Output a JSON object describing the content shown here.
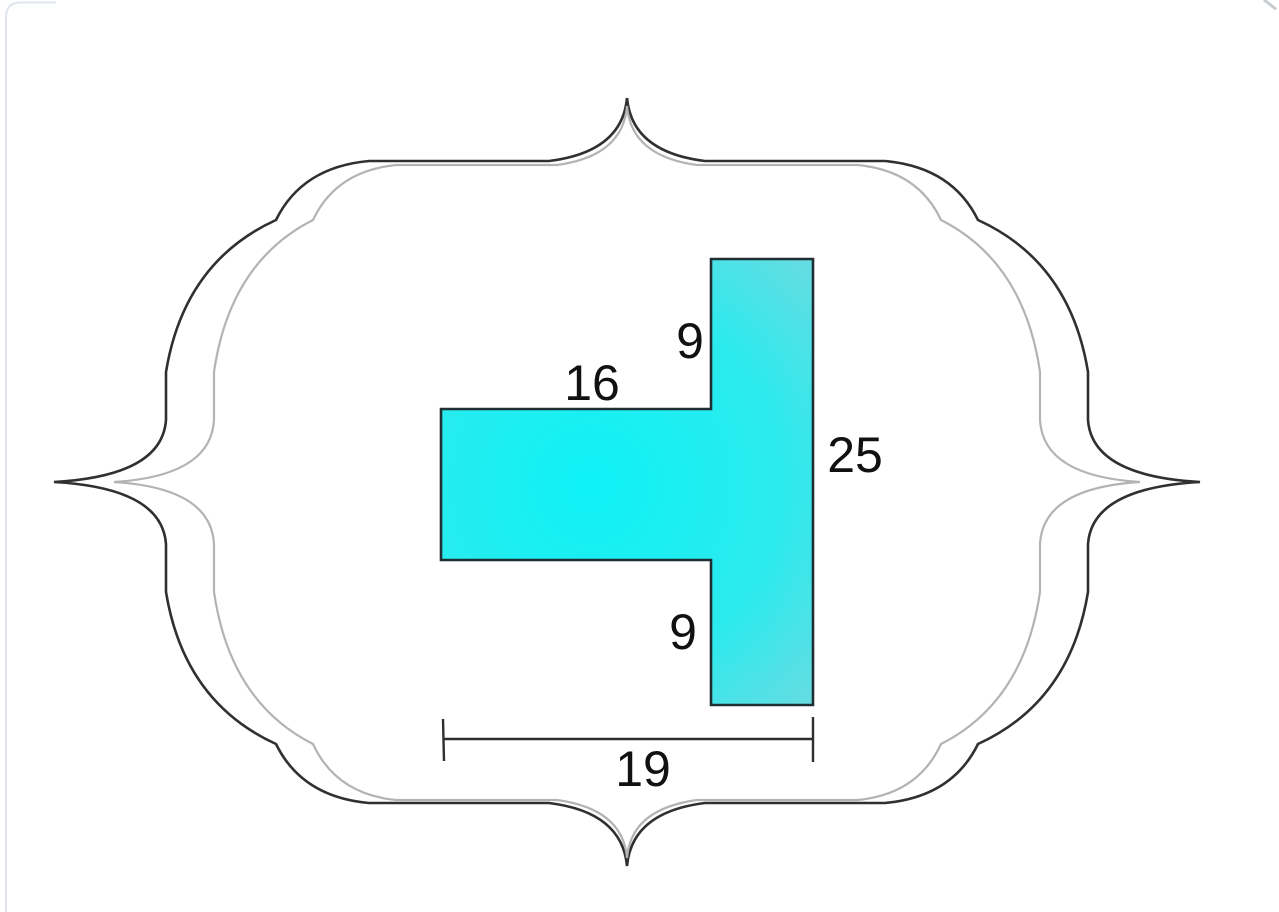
{
  "figure": {
    "description": "Composite T-shaped polygon (rotated T) with dimension labels inside an ornamental double bracket frame",
    "labels": {
      "seg_top": "9",
      "arm_top": "16",
      "right_side": "25",
      "seg_bottom": "9",
      "bottom_width": "19"
    },
    "dimensions": {
      "upper_right_vertical_segment": 9,
      "top_horizontal_arm": 16,
      "right_side_total_height": 25,
      "lower_right_vertical_segment": 9,
      "bottom_total_width": 19
    },
    "colors": {
      "frame_outer": "#303030",
      "frame_inner": "#b3b3b3",
      "shape_outline": "#1e2e33",
      "shape_center": "#0ef2f6",
      "shape_mid": "#2ceaed",
      "shape_edge": "#a0ced6",
      "dimension_line": "#2f2f2f",
      "label_text": "#111111",
      "card_border": "#dfe4ef"
    }
  }
}
